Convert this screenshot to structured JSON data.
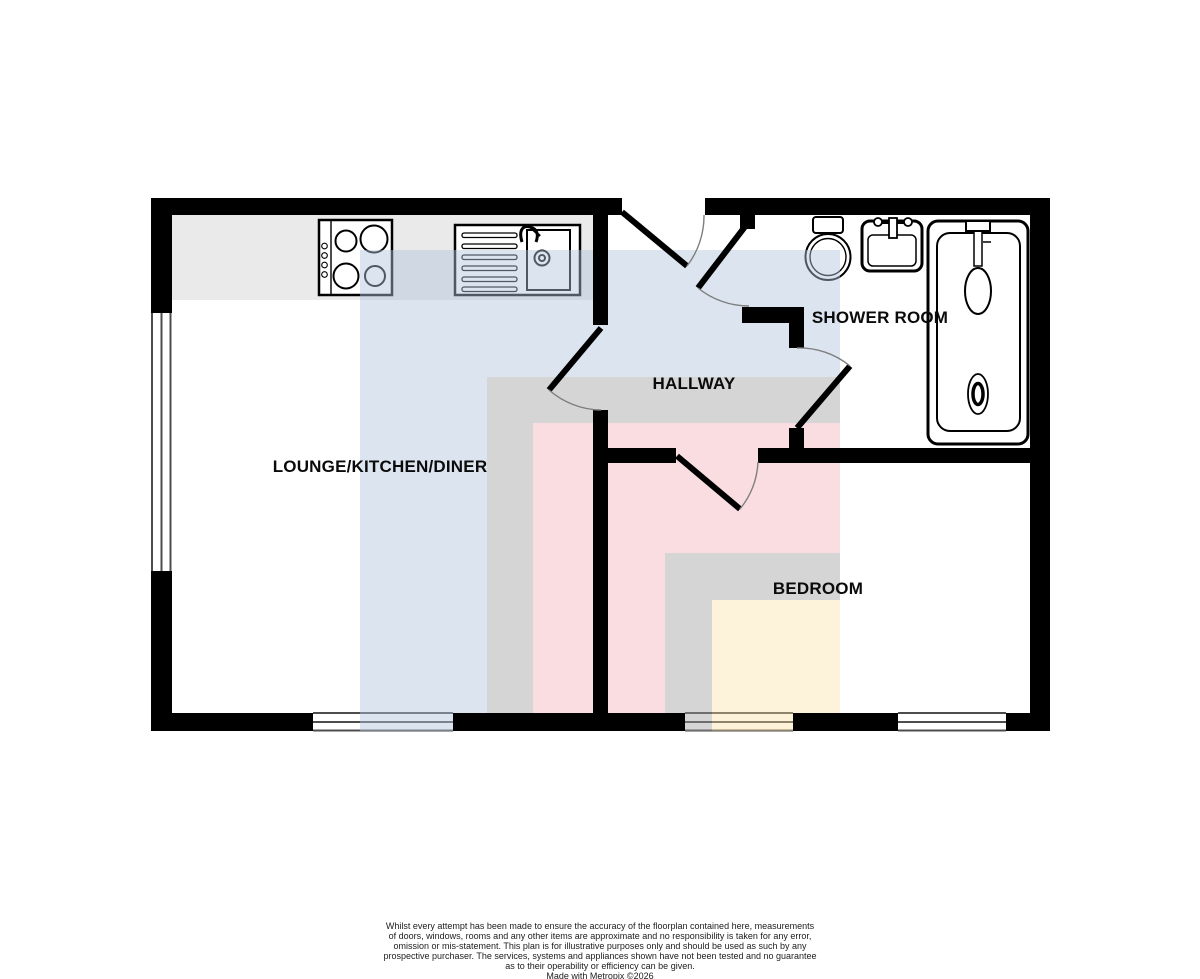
{
  "rooms": {
    "lounge": {
      "label": "LOUNGE/KITCHEN/DINER"
    },
    "hallway": {
      "label": "HALLWAY"
    },
    "shower": {
      "label": "SHOWER ROOM"
    },
    "bedroom": {
      "label": "BEDROOM"
    }
  },
  "overlays": {
    "blue": "rgba(177,195,222,0.45)",
    "gray": "rgba(155,155,157,0.42)",
    "pink": "rgba(242,166,176,0.38)",
    "gray2": "rgba(155,155,157,0.42)",
    "cream": "rgba(250,221,158,0.38)"
  },
  "colors": {
    "wall": "#000000",
    "counter": "#eaeaea",
    "window_line": "#4d4d4d",
    "door_arc": "#7e7e7e"
  },
  "disclaimer": [
    "Whilst every attempt has been made to ensure the accuracy of the floorplan contained here, measurements",
    "of doors, windows, rooms and any other items are approximate and no responsibility is taken for any error,",
    "omission or mis-statement. This plan is for illustrative purposes only and should be used as such by any",
    "prospective purchaser. The services, systems and appliances shown have not been tested and no guarantee",
    "as to their operability or efficiency can be given."
  ],
  "credit": "Made with Metropix ©2026"
}
